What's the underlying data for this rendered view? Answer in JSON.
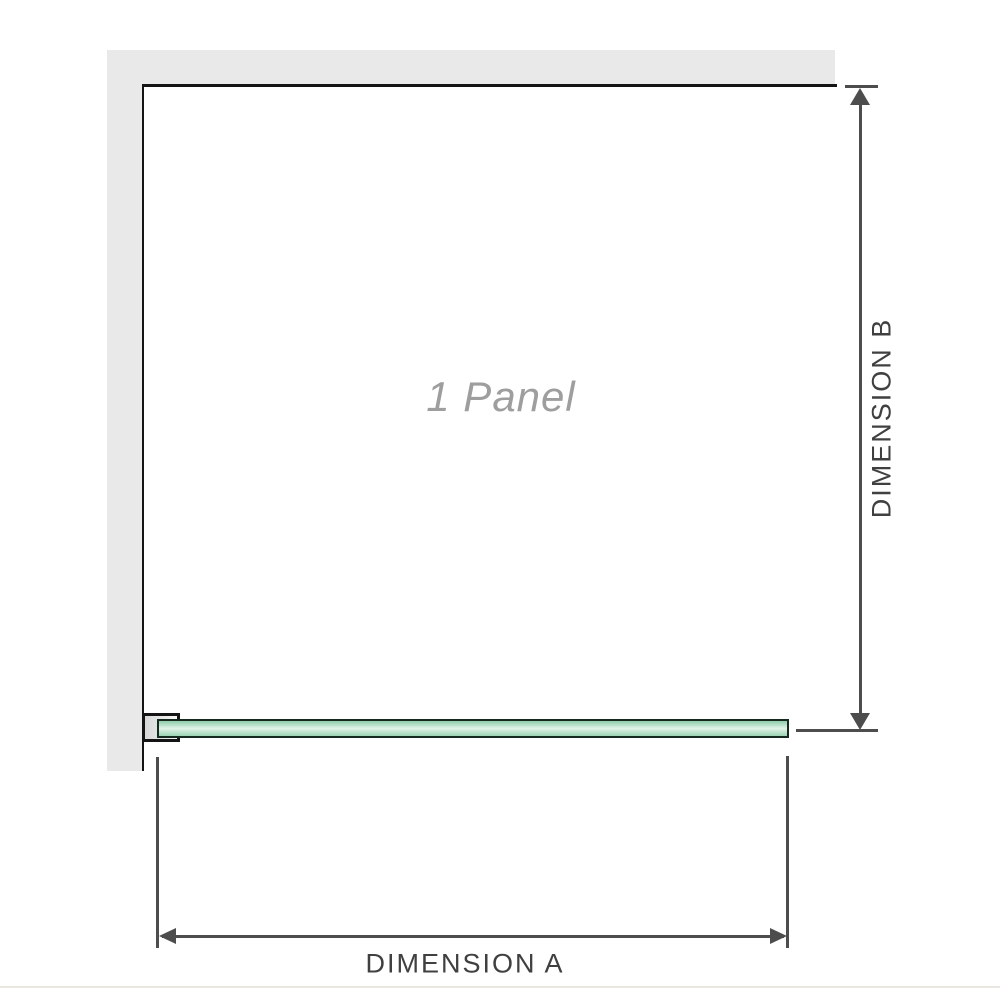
{
  "diagram": {
    "panel_label": "1 Panel",
    "dimensions": {
      "a_label": "DIMENSION A",
      "b_label": "DIMENSION B"
    },
    "colors": {
      "wall_fill": "#e9e9e9",
      "panel_outline": "#141414",
      "glass_outline": "#16291e",
      "glass_fill_top": "#8fccab",
      "glass_fill_center": "#e4f3e9",
      "glass_fill_bottom": "#9cd4b6",
      "bracket_fill": "#e3e3e3",
      "dimension_line": "#4d4d4d",
      "panel_label_text": "#9e9e9e",
      "dimension_label_text": "#404040",
      "background": "#ffffff"
    }
  }
}
